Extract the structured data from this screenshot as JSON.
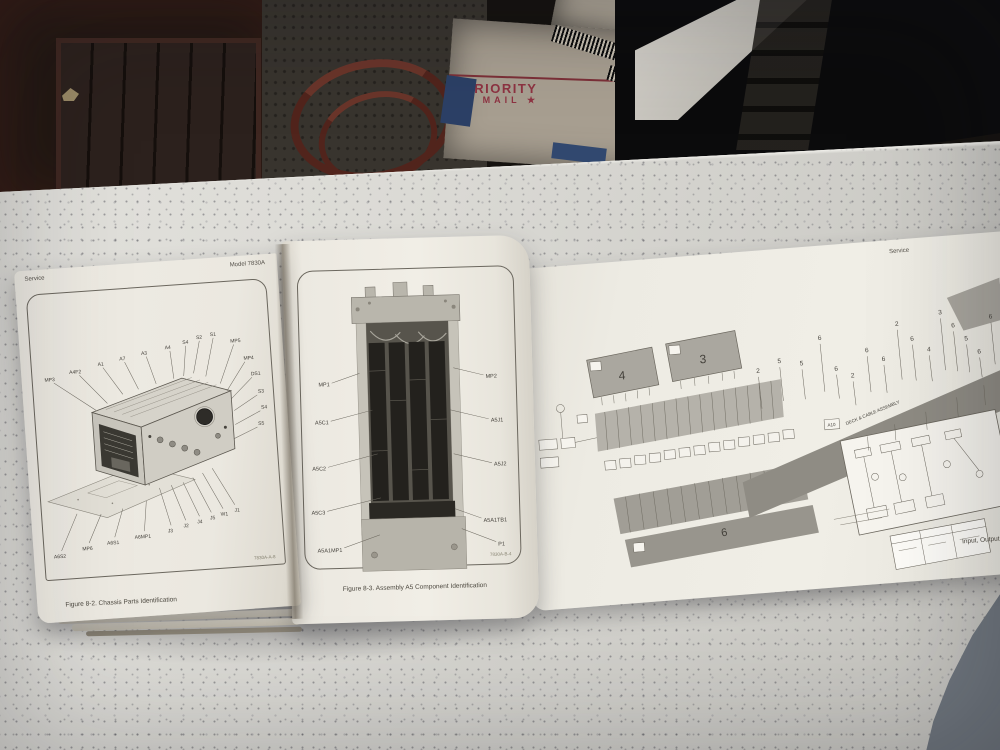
{
  "background": {
    "priority_box": {
      "line1": "PRIORITY",
      "line2": "★ MAIL ★"
    },
    "colors": {
      "priority_red": "#8e3342",
      "usps_label_blue": "#2c4066"
    }
  },
  "left_page": {
    "header_left": "Service",
    "header_right": "Model 7830A",
    "caption": "Figure 8-2. Chassis Parts Identification",
    "figure_code": "7830A-A-8",
    "callouts_top": [
      "MP3",
      "A4F2",
      "A1",
      "A7",
      "A3",
      "A4"
    ],
    "callouts_arc": [
      "S4",
      "S2",
      "S1",
      "MP5"
    ],
    "callouts_right": [
      "MP4",
      "DS1",
      "S3",
      "S4",
      "S5"
    ],
    "callouts_bottom": [
      "A6S2",
      "MP6",
      "A6S1",
      "A6MP1",
      "J3",
      "J2",
      "J4",
      "J5",
      "W1",
      "J1"
    ]
  },
  "middle_page": {
    "caption": "Figure 8-3. Assembly A5 Component Identification",
    "figure_code": "7830A-B-4",
    "callouts_left": [
      "MP1",
      "A5C1",
      "A5C2",
      "A5C3",
      "A5A1MP1"
    ],
    "callouts_right": [
      "MP2",
      "A5J1",
      "A5J2",
      "A5A1TB1",
      "P1"
    ]
  },
  "foldout_page": {
    "header_right": "Service",
    "caption_partial": "Input, Output",
    "cable_label_ref": "A10",
    "cable_label": "DECK & CABLE ASSEMBLY",
    "block_numbers": [
      "4",
      "3",
      "6"
    ],
    "ref_numbers": [
      "2",
      "5",
      "5",
      "6",
      "6",
      "2",
      "6",
      "6",
      "2",
      "6",
      "4",
      "3",
      "6",
      "5",
      "6",
      "6"
    ]
  }
}
